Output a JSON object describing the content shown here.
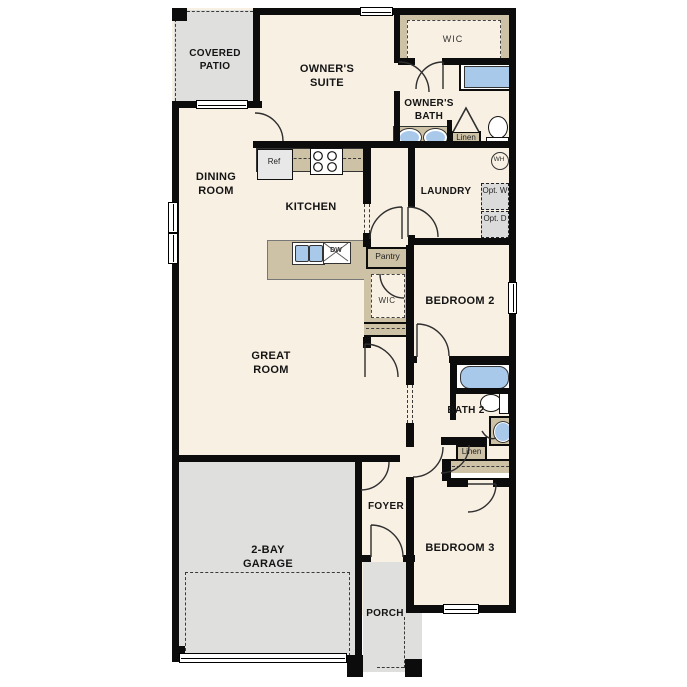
{
  "colors": {
    "floor": "#f8f0e3",
    "outdoor": "#dfdfde",
    "cabinet_tan": "#cdc1a6",
    "fixture_blue": "#a9c9eb",
    "optional_grey": "#dbdbdb",
    "wall": "#0c0c0c"
  },
  "rooms": {
    "covered_patio": "COVERED PATIO",
    "owners_suite": "OWNER'S SUITE",
    "owners_wic": "WIC",
    "owners_bath": "OWNER'S BATH",
    "dining_room": "DINING ROOM",
    "kitchen": "KITCHEN",
    "laundry": "LAUNDRY",
    "great_room": "GREAT ROOM",
    "bedroom_2": "BEDROOM 2",
    "bedroom_2_wic": "WIC",
    "bath_2": "BATH 2",
    "bedroom_3": "BEDROOM 3",
    "foyer": "FOYER",
    "porch": "PORCH",
    "garage": "2-BAY GARAGE"
  },
  "fixtures": {
    "refrigerator": "Ref",
    "dishwasher": "DW",
    "pantry": "Pantry",
    "owners_linen": "Linen",
    "hall_linen": "Linen",
    "water_heater": "WH",
    "opt_washer": "Opt. W",
    "opt_dryer": "Opt. D"
  }
}
